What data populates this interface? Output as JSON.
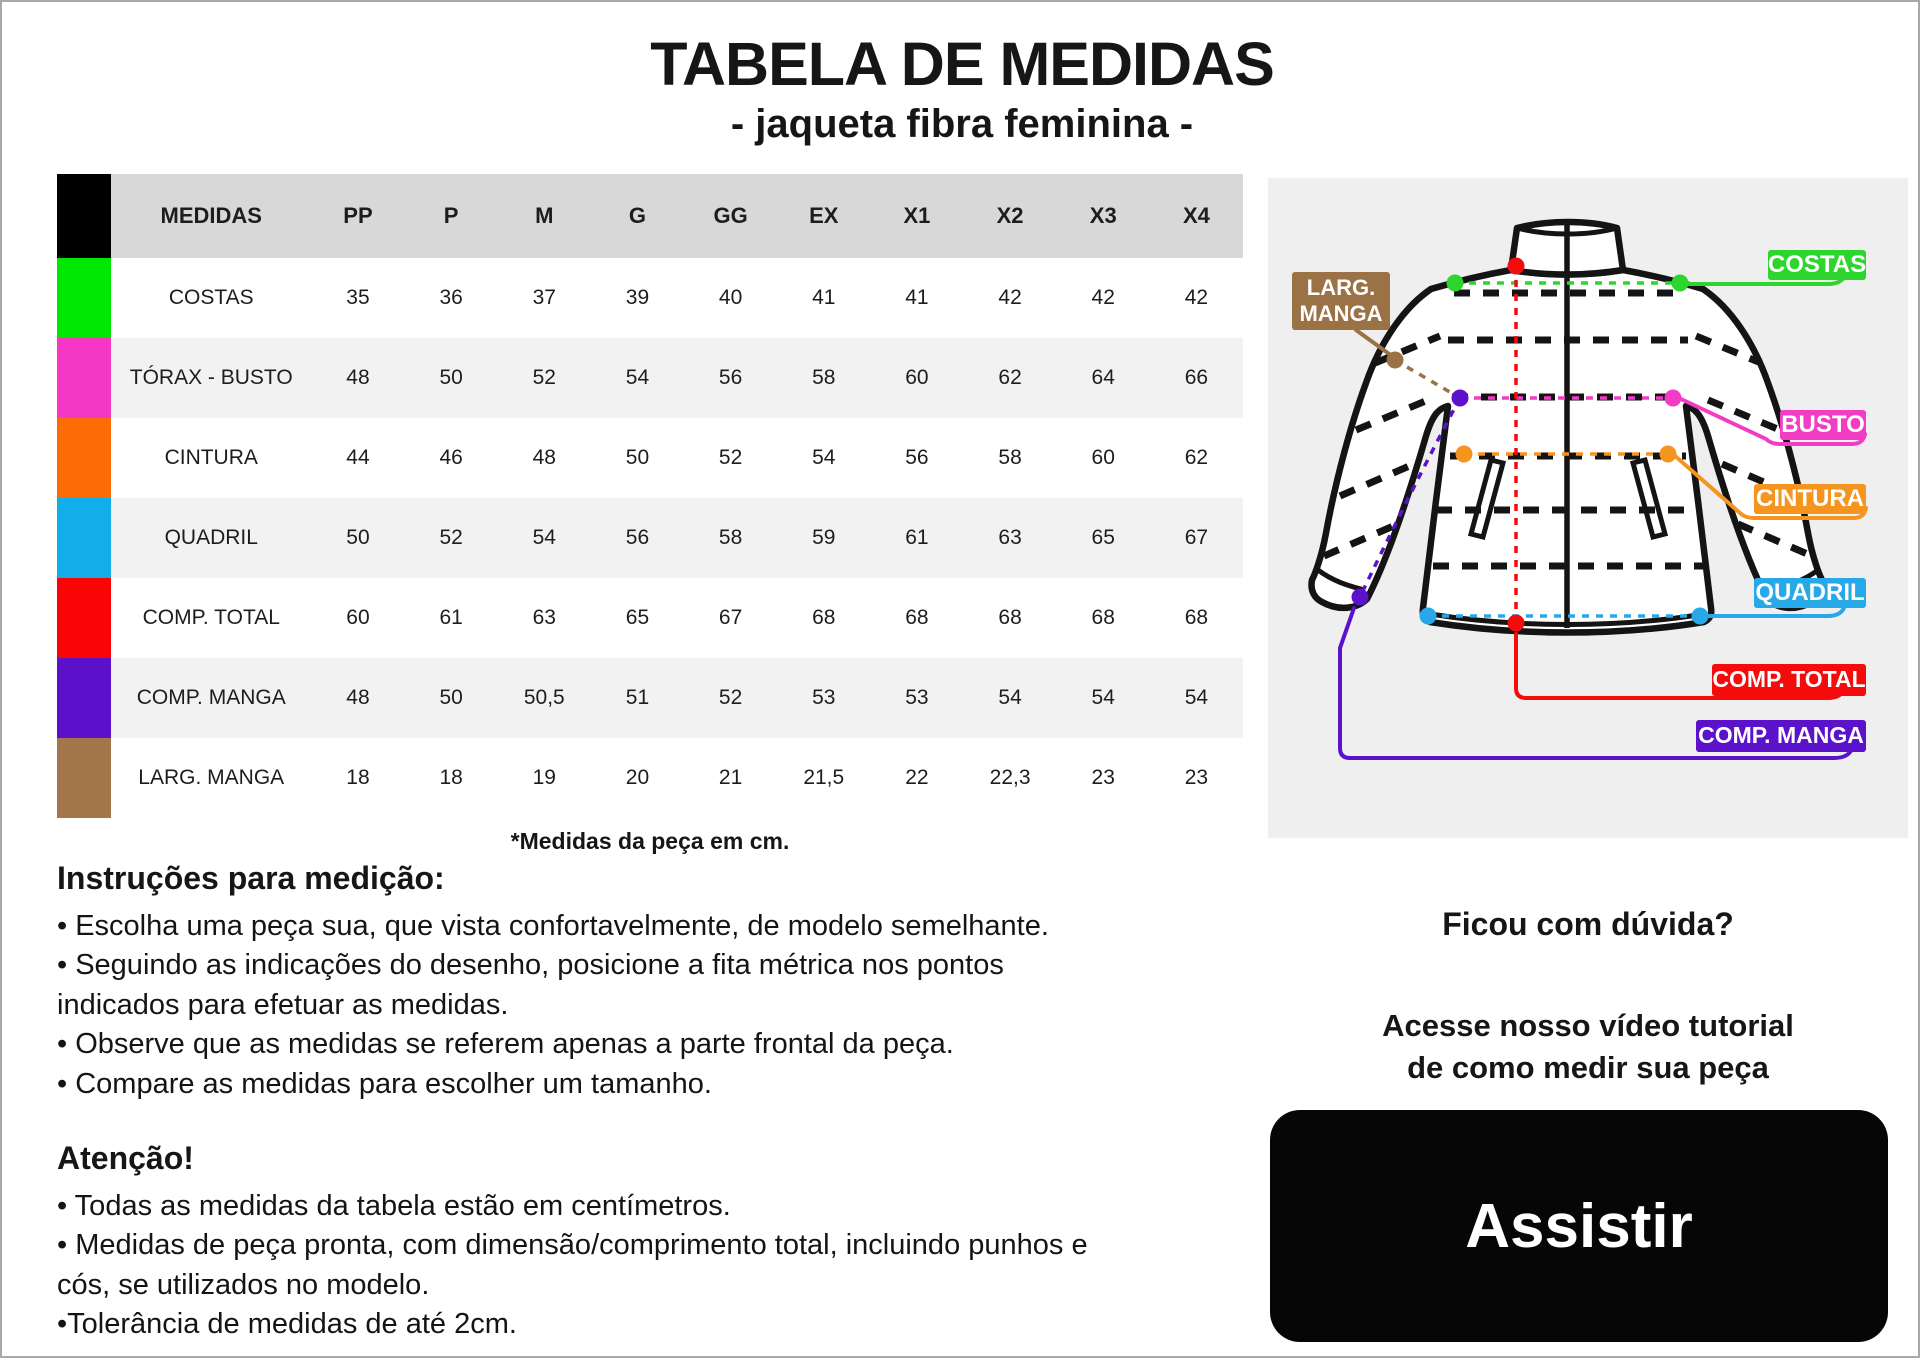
{
  "page": {
    "title": "TABELA DE MEDIDAS",
    "subtitle": "- jaqueta fibra feminina -"
  },
  "table": {
    "header": {
      "label": "MEDIDAS",
      "sizes": [
        "PP",
        "P",
        "M",
        "G",
        "GG",
        "EX",
        "X1",
        "X2",
        "X3",
        "X4"
      ],
      "swatch_color": "#000000",
      "header_bg": "#d8d8d8",
      "stripe_bg": "#f2f2f2"
    },
    "rows": [
      {
        "label": "COSTAS",
        "color": "#00e701",
        "values": [
          "35",
          "36",
          "37",
          "39",
          "40",
          "41",
          "41",
          "42",
          "42",
          "42"
        ]
      },
      {
        "label": "TÓRAX - BUSTO",
        "color": "#f437c4",
        "values": [
          "48",
          "50",
          "52",
          "54",
          "56",
          "58",
          "60",
          "62",
          "64",
          "66"
        ]
      },
      {
        "label": "CINTURA",
        "color": "#fb6d04",
        "values": [
          "44",
          "46",
          "48",
          "50",
          "52",
          "54",
          "56",
          "58",
          "60",
          "62"
        ]
      },
      {
        "label": "QUADRIL",
        "color": "#11aee9",
        "values": [
          "50",
          "52",
          "54",
          "56",
          "58",
          "59",
          "61",
          "63",
          "65",
          "67"
        ]
      },
      {
        "label": "COMP. TOTAL",
        "color": "#fa0505",
        "values": [
          "60",
          "61",
          "63",
          "65",
          "67",
          "68",
          "68",
          "68",
          "68",
          "68"
        ]
      },
      {
        "label": "COMP. MANGA",
        "color": "#5b10ca",
        "values": [
          "48",
          "50",
          "50,5",
          "51",
          "52",
          "53",
          "53",
          "54",
          "54",
          "54"
        ]
      },
      {
        "label": "LARG. MANGA",
        "color": "#a3764b",
        "values": [
          "18",
          "18",
          "19",
          "20",
          "21",
          "21,5",
          "22",
          "22,3",
          "23",
          "23"
        ]
      }
    ],
    "footnote": "*Medidas da peça em cm."
  },
  "diagram": {
    "panel_bg": "#efefef",
    "labels": {
      "costas": "COSTAS",
      "busto": "BUSTO",
      "cintura": "CINTURA",
      "quadril": "QUADRIL",
      "comp_total": "COMP. TOTAL",
      "comp_manga": "COMP. MANGA",
      "larg_manga_line1": "LARG.",
      "larg_manga_line2": "MANGA"
    },
    "colors": {
      "costas": "#2ed52e",
      "busto": "#f23cc3",
      "cintura": "#f5941f",
      "quadril": "#27a8e8",
      "comp_total": "#f40b0b",
      "comp_manga": "#5c12cb",
      "larg_manga": "#9b7146"
    }
  },
  "instructions": {
    "heading": "Instruções para medição:",
    "bullets": [
      "• Escolha uma peça sua, que vista confortavelmente, de modelo semelhante.",
      "• Seguindo as indicações do desenho, posicione a fita métrica nos pontos indicados para efetuar as medidas.",
      "• Observe que as medidas se referem apenas a parte frontal da peça.",
      "• Compare as medidas para escolher um tamanho."
    ]
  },
  "attention": {
    "heading": "Atenção!",
    "bullets": [
      "• Todas as medidas da tabela estão em centímetros.",
      "• Medidas de peça pronta, com dimensão/comprimento total, incluindo punhos e cós, se utilizados no modelo.",
      "•Tolerância de medidas de até 2cm."
    ]
  },
  "help": {
    "question": "Ficou com dúvida?",
    "line1": "Acesse nosso vídeo tutorial",
    "line2": "de como medir sua peça",
    "button_label": "Assistir"
  }
}
